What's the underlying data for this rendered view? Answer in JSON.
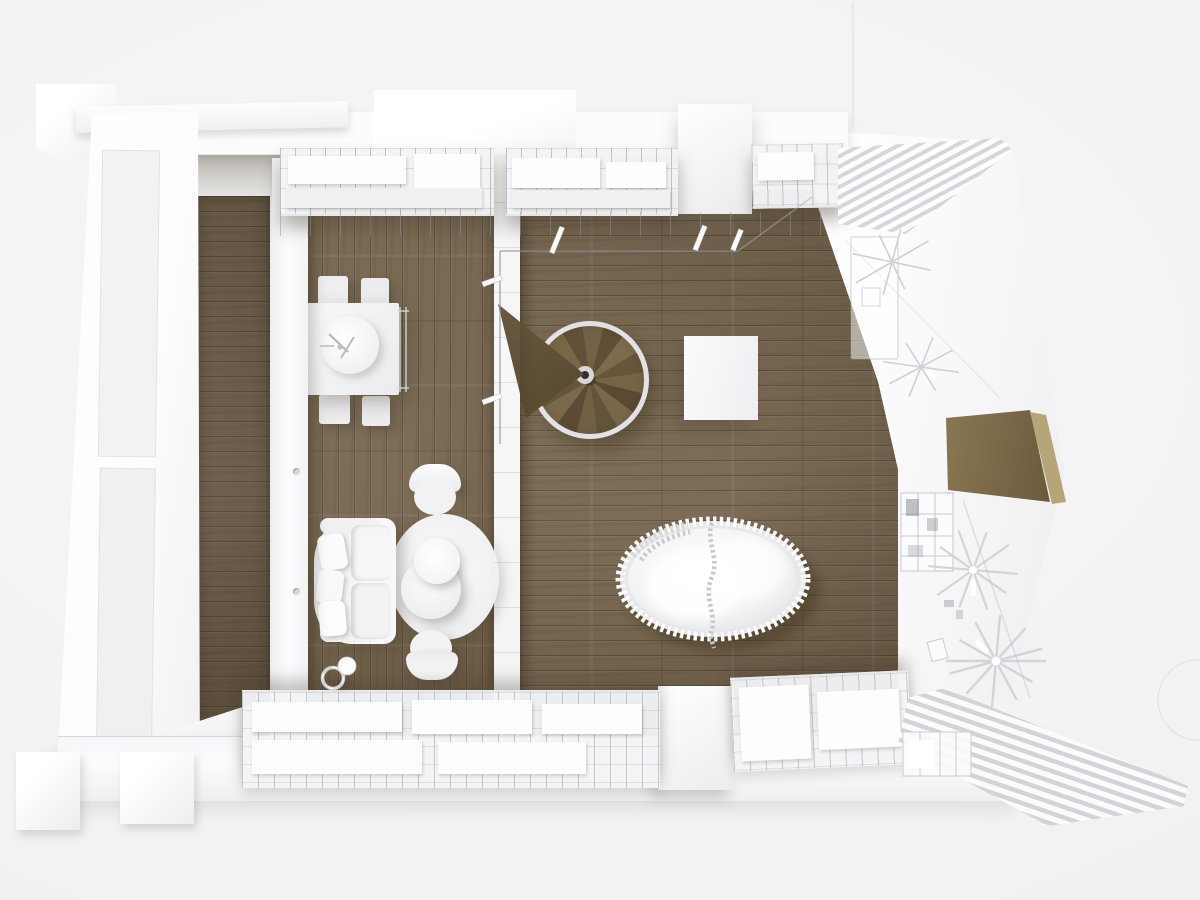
{
  "meta": {
    "title": "Overhead 3D render of a minimalist white loft apartment with oak parquet flooring",
    "style": "white monochrome architectural visualization, sectioned walls, top-down view",
    "view": "top-down"
  },
  "palette": {
    "background": "#f1f1f3",
    "wall_white": "#fcfcfd",
    "floor_wood": "#77664e",
    "floor_wood_dark": "#5e4f39",
    "stair_wood": "#6b5a40",
    "wireframe_gray": "#cdd0d4",
    "shadow": "rgba(70,60,45,0.35)"
  },
  "areas": {
    "corridor": {
      "label": "Entry corridor with oak flooring"
    },
    "living": {
      "label": "Living and dining room"
    },
    "hall": {
      "label": "Central hall with spiral staircase and daybed"
    },
    "workspace": {
      "label": "White-floor study area with transparent furniture"
    }
  },
  "objects": {
    "dining_table": {
      "label": "Square dining table with round centerpiece and four stools"
    },
    "sofa": {
      "label": "White sofa with loose cushions"
    },
    "rug": {
      "label": "Round area rug"
    },
    "coffee_table": {
      "label": "Stacked round coffee tables"
    },
    "armchair_top": {
      "label": "Round-back armchair"
    },
    "armchair_bottom": {
      "label": "Round-back armchair"
    },
    "floor_lamp": {
      "label": "Small sphere floor lamp"
    },
    "spiral_stair": {
      "label": "Wooden spiral staircase seen from above"
    },
    "landing": {
      "label": "Tapered wooden stair landing"
    },
    "railing": {
      "label": "Glass balustrade with white posts"
    },
    "side_table": {
      "label": "White block side table"
    },
    "bed": {
      "label": "Ruffled oval daybed with centre seam"
    },
    "desk_glass": {
      "label": "Transparent desk with ghost chairs"
    },
    "desk_wood": {
      "label": "Slanted wooden desk panel"
    },
    "cabinet": {
      "label": "Wireframe storage cabinet"
    },
    "sculptures": {
      "label": "Radial wireframe fan sculptures"
    },
    "shelf_top": {
      "label": "Wire shelving with white storage boxes along top wall"
    },
    "shelf_bottom": {
      "label": "Wire shelving with white storage boxes along bottom wall"
    },
    "louvers_top": {
      "label": "Diagonal louver / stair slats, upper right"
    },
    "louvers_bottom": {
      "label": "Diagonal slatted ramp, lower right"
    },
    "walls": {
      "label": "Sectioned white walls and piers"
    }
  }
}
